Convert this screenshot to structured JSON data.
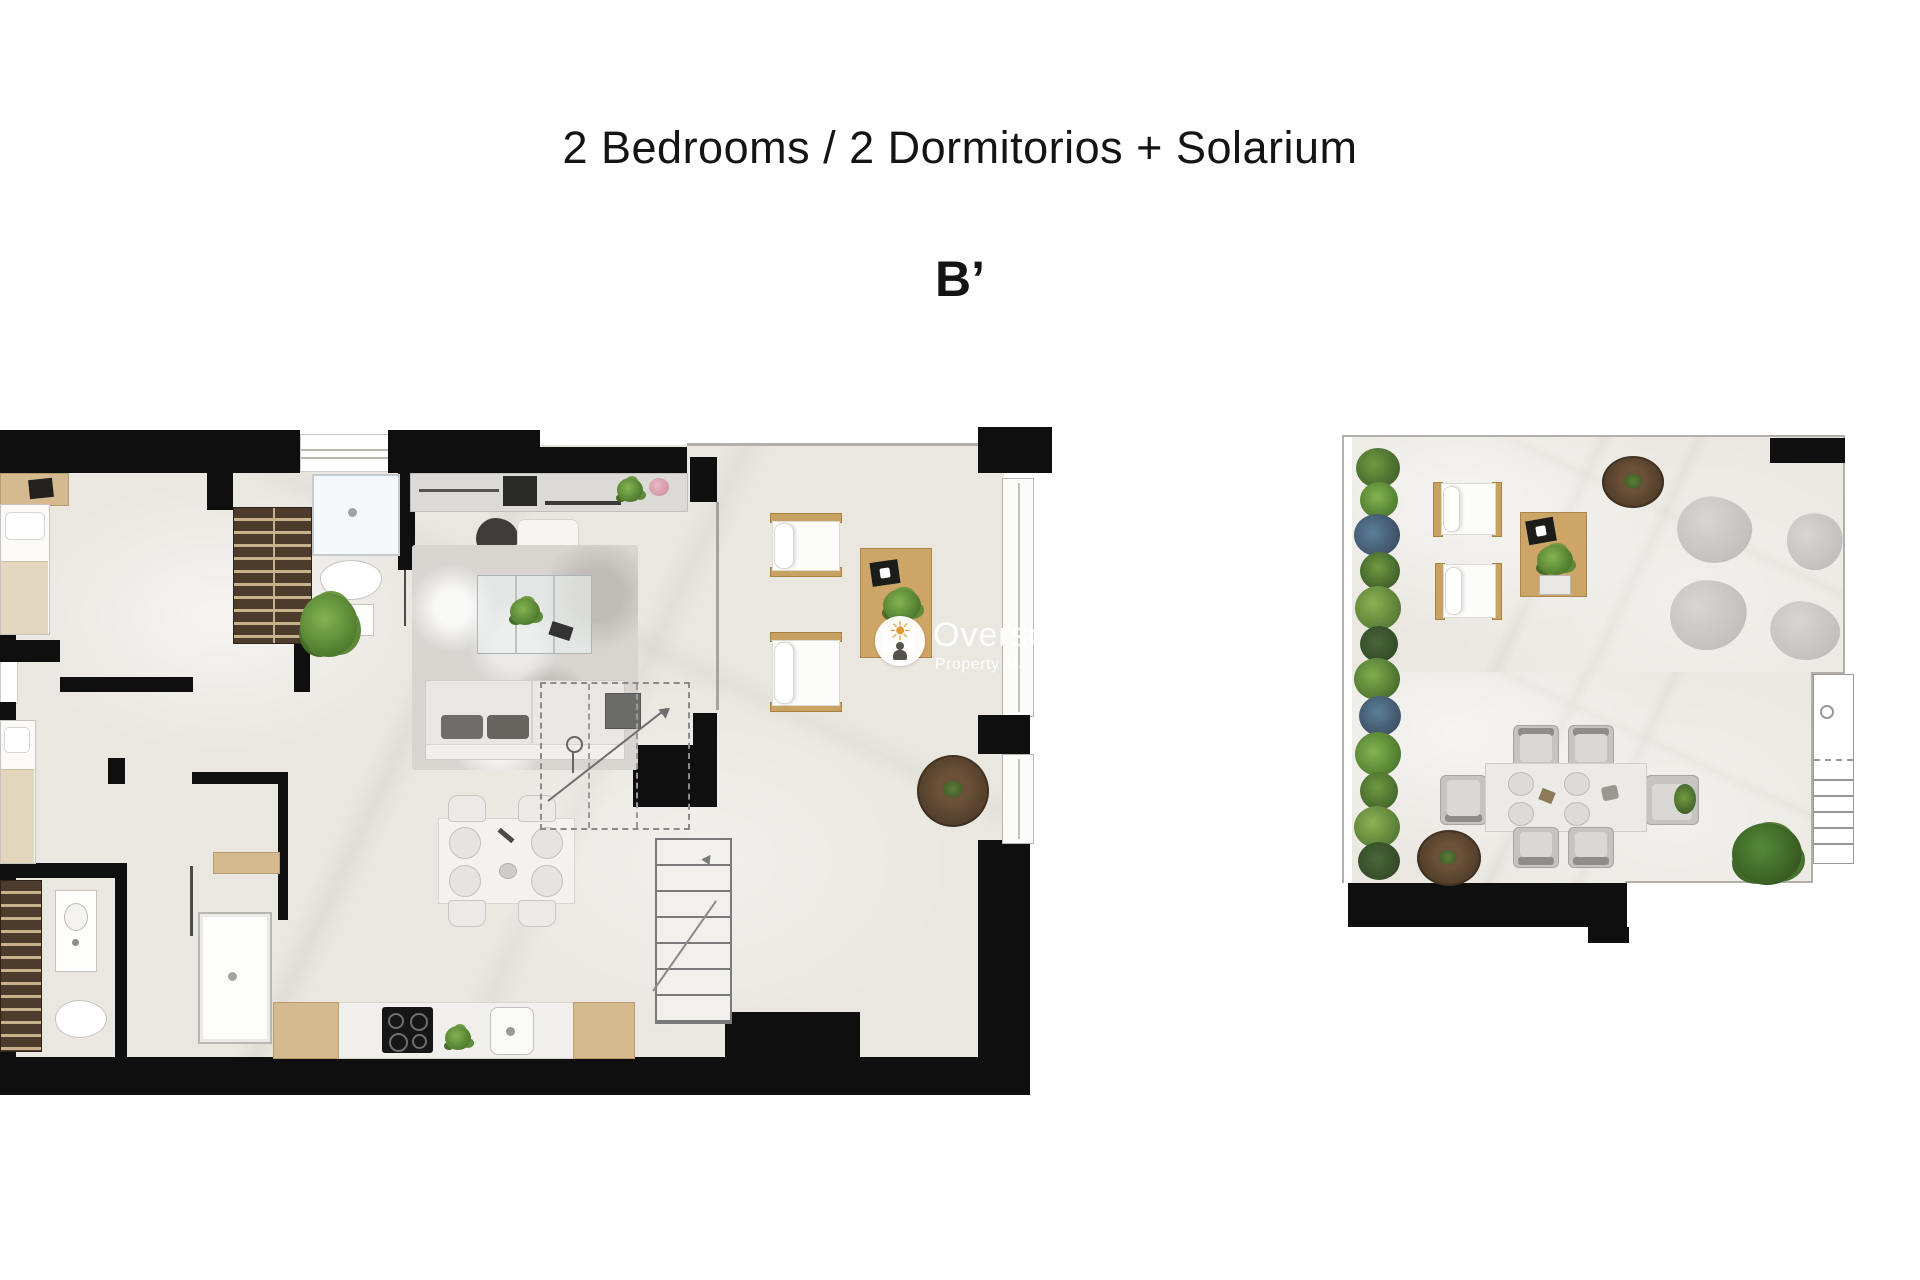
{
  "header": {
    "title": "2 Bedrooms / 2 Dormitorios + Solarium",
    "plan_label": "B’"
  },
  "watermark": {
    "line1": "Overseas",
    "line2": "Property Mark",
    "icon": "sun-person-badge",
    "accent_color": "#e19a33",
    "badge_color": "#ffffff"
  },
  "plans": [
    {
      "id": "apartment",
      "name": "Main floor — 2 bedroom apartment",
      "rooms": [
        {
          "name": "bedroom-1",
          "furniture": [
            "double-bed",
            "dresser-tv",
            "built-in-wardrobe"
          ]
        },
        {
          "name": "bathroom-1",
          "furniture": [
            "shower",
            "toilet",
            "washbasin"
          ]
        },
        {
          "name": "living-dining-room",
          "furniture": [
            "tv-media-unit",
            "sofa",
            "area-rug",
            "coffee-table",
            "ottoman",
            "floor-lamp",
            "dining-table-4-seats",
            "potted-plant"
          ]
        },
        {
          "name": "kitchen",
          "furniture": [
            "counter",
            "cooktop-4-burners",
            "sink",
            "herb-pot"
          ]
        },
        {
          "name": "staircase",
          "furniture": [
            "lower-flight",
            "upper-flight-dashed"
          ]
        },
        {
          "name": "terrace",
          "furniture": [
            "sun-lounger",
            "sun-lounger",
            "side-table",
            "round-planter",
            "glass-railing"
          ]
        },
        {
          "name": "bedroom-2",
          "furniture": [
            "double-bed",
            "wardrobe"
          ]
        },
        {
          "name": "bathroom-2",
          "furniture": [
            "shower",
            "toilet",
            "washbasin",
            "wardrobe"
          ]
        }
      ]
    },
    {
      "id": "solarium",
      "name": "Roof solarium",
      "rooms": [
        {
          "name": "solarium-deck",
          "furniture": [
            "hedge-planter-strip",
            "sun-lounger",
            "sun-lounger",
            "side-table",
            "bean-bag",
            "bean-bag",
            "bean-bag",
            "bean-bag",
            "dining-table-6-seats",
            "round-planter",
            "round-planter",
            "bush",
            "stair-access"
          ]
        }
      ]
    }
  ],
  "palette": {
    "wall": "#0f0f0f",
    "floor": "#eae7e1",
    "wood_light": "#d6ba8f",
    "wood_mid": "#cda566",
    "wardrobe_dark": "#4d3c2c",
    "rug": "#d8d5d1",
    "greenery": "#4e7a2e",
    "planter_brown": "#4e3b29",
    "pouf_gray": "#c6c4c0"
  }
}
